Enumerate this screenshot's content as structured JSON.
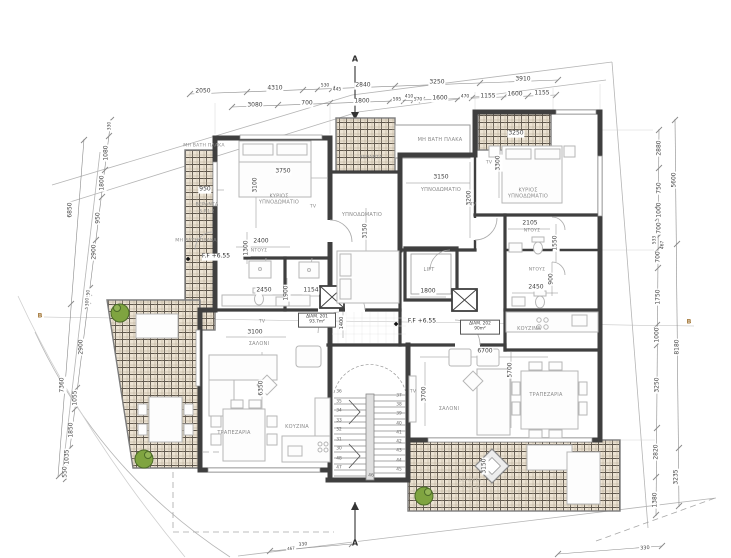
{
  "markers": {
    "section_a_top": "A",
    "section_a_bottom": "A",
    "section_b_left": "B",
    "section_b_right": "B"
  },
  "levels": {
    "left": "F.F +6.55",
    "center": "F.F +6.55"
  },
  "apartments": [
    {
      "name": "ΔΙΑΜ. 201",
      "area": "93.7m²"
    },
    {
      "name": "ΔΙΑΜ. 202",
      "area": "90m²"
    }
  ],
  "rooms": {
    "labels": [
      {
        "id": "slab-top-left",
        "label": "ΜΗ ΒΑΤΗ ΠΛΑΚΑ"
      },
      {
        "id": "slab-mid-left",
        "label": "ΜΗ ΒΑΤΗ ΠΛΑΚΑ"
      },
      {
        "id": "slab-center",
        "label": "ΜΗ ΒΑΤΗ ΠΛΑΚΑ"
      },
      {
        "id": "veranda-left",
        "label": "ΒΕΡΑΝΤΑ"
      },
      {
        "id": "veranda-left-area",
        "label": "S.P.1.2"
      },
      {
        "id": "master-bedroom-left",
        "label": "ΚΥΡΙΟΣ ΥΠΝΟΔΩΜΑΤΙΟ"
      },
      {
        "id": "bedroom-mid-left",
        "label": "ΥΠΝΟΔΩΜΑΤΙΟ"
      },
      {
        "id": "bedroom-center",
        "label": "ΥΠΝΟΔΩΜΑΤΙΟ"
      },
      {
        "id": "master-bedroom-right",
        "label": "ΚΥΡΙΟΣ ΥΠΝΟΔΩΜΑΤΙΟ"
      },
      {
        "id": "shower-left",
        "label": "ΝΤΟΥΣ"
      },
      {
        "id": "shower-right-top",
        "label": "ΝΤΟΥΣ"
      },
      {
        "id": "shower-right-mid",
        "label": "ΝΤΟΥΣ"
      },
      {
        "id": "lift",
        "label": "LIFT"
      },
      {
        "id": "kitchen-right",
        "label": "ΚΟΥΖΙΝΑ"
      },
      {
        "id": "kitchen-left",
        "label": "ΚΟΥΖΙΝΑ"
      },
      {
        "id": "living-left",
        "label": "ΣΑΛΟΝΙ"
      },
      {
        "id": "living-right",
        "label": "ΣΑΛΟΝΙ"
      },
      {
        "id": "dining-left",
        "label": "ΤΡΑΠΕΖΑΡΙΑ"
      },
      {
        "id": "dining-right",
        "label": "ΤΡΑΠΕΖΑΡΙΑ"
      },
      {
        "id": "veranda-top",
        "label": "ΒΕΡΑΝΤΑ"
      },
      {
        "id": "veranda-bottom-right",
        "label": "ΒΕΡΑΝΤΑ"
      },
      {
        "id": "veranda-bottom-right-level",
        "label": "F.F +6.50"
      },
      {
        "id": "tv-1",
        "label": "TV"
      },
      {
        "id": "tv-2",
        "label": "TV"
      },
      {
        "id": "tv-3",
        "label": "TV"
      },
      {
        "id": "tv-4",
        "label": "TV"
      },
      {
        "id": "tv-5",
        "label": "TV"
      }
    ]
  },
  "dims": {
    "top_row1": [
      "2050",
      "4310",
      "530",
      "445",
      "2840",
      "3250",
      "3910"
    ],
    "top_row2": [
      "3080",
      "700",
      "1800",
      "595",
      "410",
      "570",
      "1600",
      "470",
      "1155",
      "1600",
      "1155"
    ],
    "left_inner": [
      "330",
      "1080",
      "1800",
      "950",
      "2900",
      "250",
      "300",
      "2900",
      "1055",
      "1850",
      "1035",
      "550"
    ],
    "left_outer": [
      "6850",
      "7360"
    ],
    "right_inner": [
      "2880",
      "750",
      "1000",
      "700",
      "533",
      "467",
      "700",
      "1750",
      "1000",
      "3250",
      "2820",
      "1380"
    ],
    "right_outer": [
      "5600",
      "8180",
      "3235"
    ],
    "bottom": [
      "467",
      "330",
      "330"
    ],
    "interior": [
      "3750",
      "3100",
      "950",
      "2400",
      "1300",
      "2450",
      "1900",
      "1154",
      "3150",
      "3250",
      "3300",
      "3200",
      "2105",
      "1550",
      "900",
      "2450",
      "1800",
      "6700",
      "5700",
      "3700",
      "6350",
      "3100",
      "3150",
      "1400",
      "3150"
    ]
  },
  "stairs": {
    "left": [
      "36",
      "35",
      "34",
      "33",
      "32",
      "31",
      "30",
      "48",
      "47"
    ],
    "right": [
      "37",
      "38",
      "39",
      "40",
      "41",
      "42",
      "43",
      "44",
      "45"
    ],
    "bottom": "46"
  },
  "colors": {
    "wall": "#3f3f3f",
    "hatch_bg": "#ece3d3",
    "hatch_line": "#5f574c",
    "furniture": "#b6b6b6",
    "plant_green": "#7fa440",
    "dim_text": "#3f3f3f",
    "marker_b": "#a5793a"
  }
}
